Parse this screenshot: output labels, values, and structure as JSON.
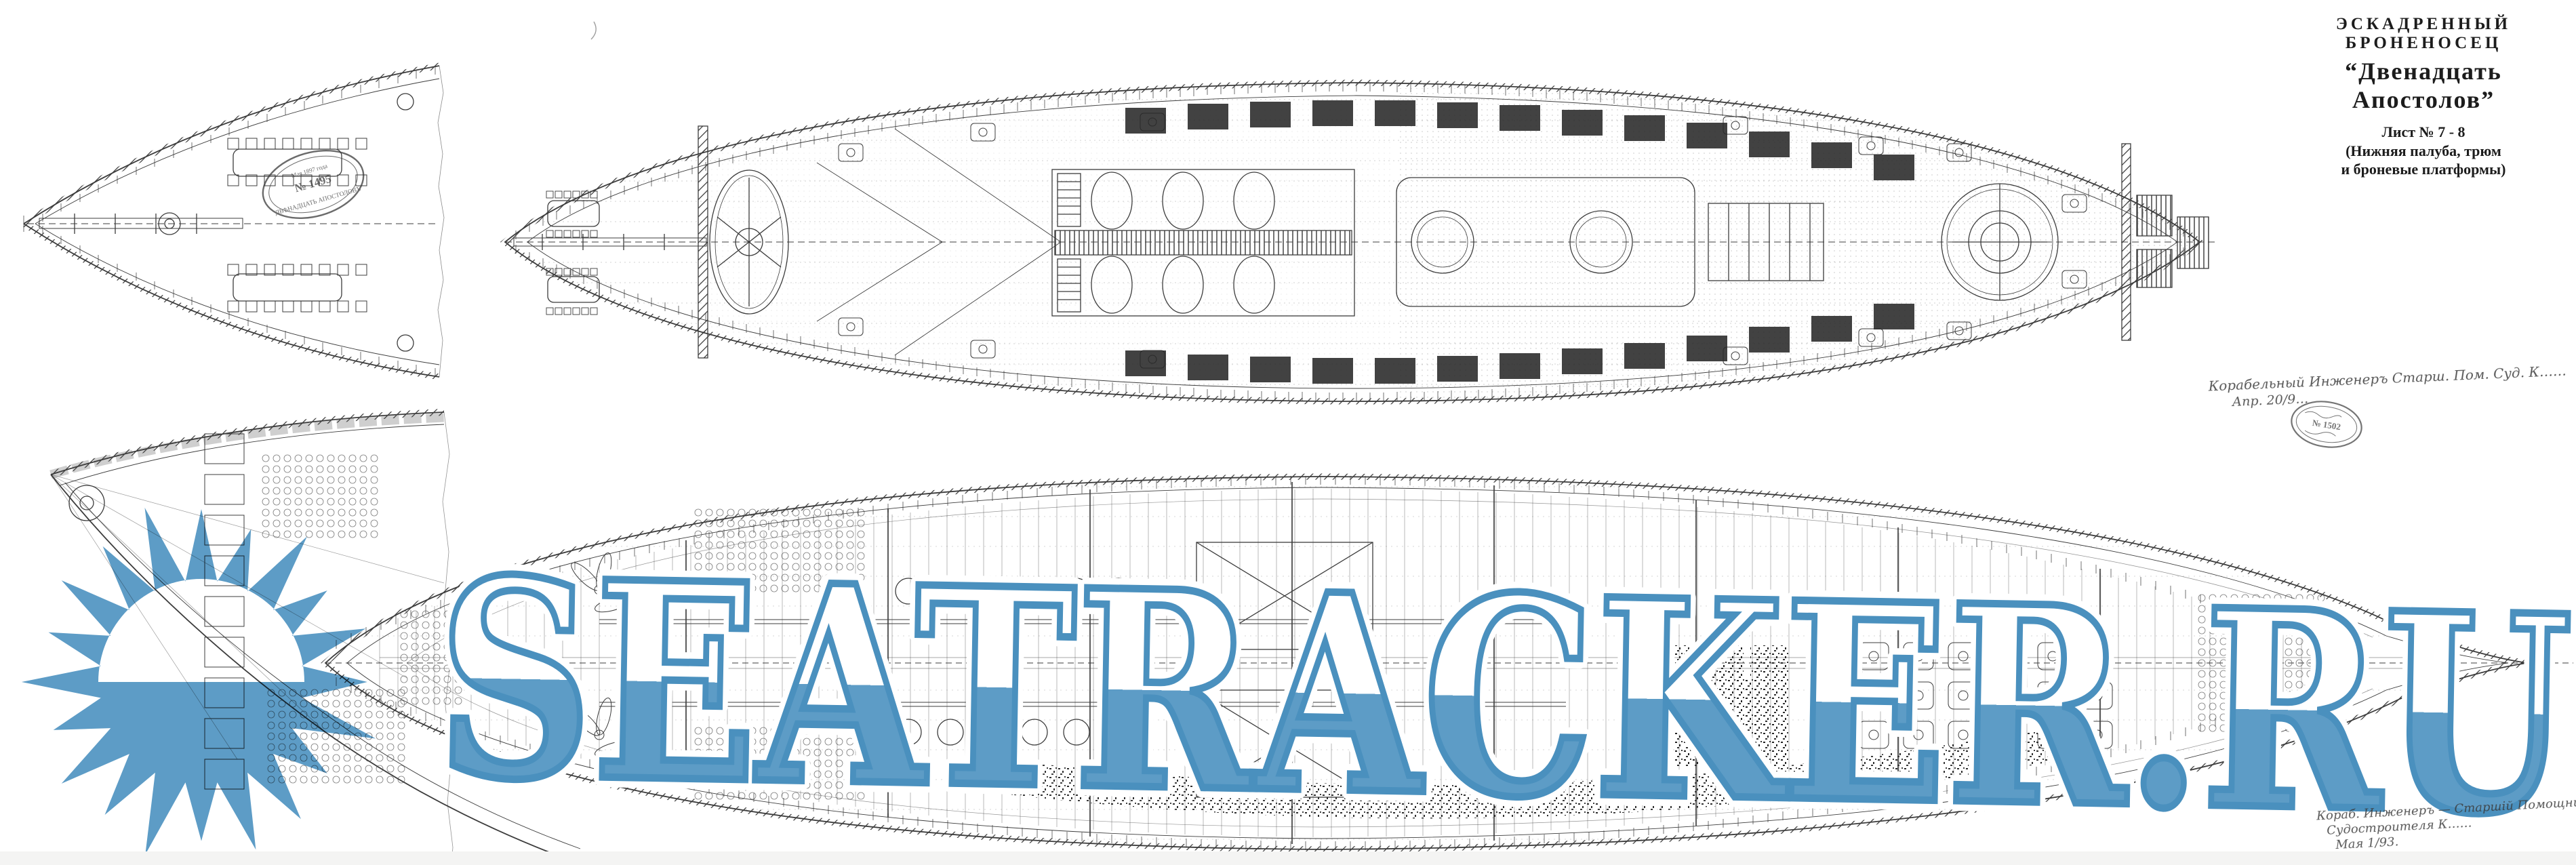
{
  "page": {
    "background": "#ffffff"
  },
  "title_block": {
    "line1": "ЭСКАДРЕННЫЙ БРОНЕНОСЕЦ",
    "line2": "“Двенадцать Апостолов”",
    "line3": "Лист № 7 - 8",
    "line4": "(Нижняя палуба, трюм",
    "line5": "и броневые платформы)"
  },
  "watermark": {
    "text": "SEATRACKER.RU",
    "fill_color": "#5d9cc6",
    "outline_color": "#4a90be",
    "logo": "sunburst-icon"
  },
  "stamps": {
    "bow_fragment_stamp": {
      "top": "Мая 1897 года",
      "number": "№ 1495",
      "bottom": "ДВѢНАДЦАТЬ АПОСТОЛОВЪ"
    },
    "registry_stamp": {
      "number": "№ 1502"
    }
  },
  "annotations": {
    "signature_upper_line1": "Корабельный Инженеръ Старш. Пом. Суд. К……",
    "signature_upper_line2": "Апр. 20/9…",
    "signature_lower_line1": "Кораб. Инженеръ — Старшій Помощникъ —",
    "signature_lower_line2": "Судостроителя К……",
    "signature_lower_line3": "Мая 1/93."
  }
}
